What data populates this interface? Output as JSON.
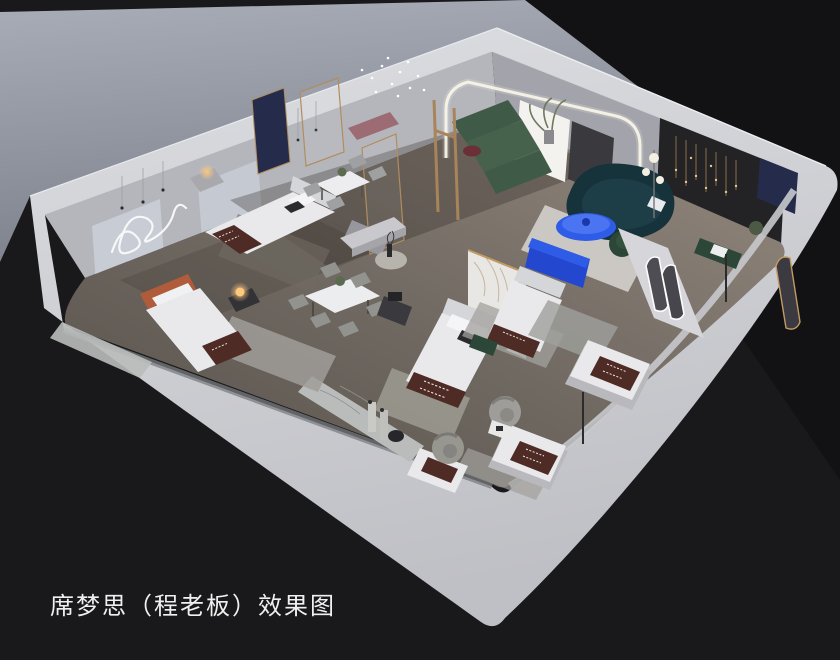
{
  "caption": "席梦思（程老板）效果图",
  "scene_type": "isometric-cutaway-interior-rendering",
  "colors": {
    "bg": "#19191b",
    "bg_deep": "#121214",
    "backdrop_hi": "#a9adb8",
    "backdrop_lo": "#7e828c",
    "shell": "#cfd0d4",
    "shell_hi": "#dddee2",
    "shell_lo": "#bfc0c5",
    "wall_left": "#b5b6bc",
    "wall_left_lo": "#9698a0",
    "wall_right": "#a3a4ab",
    "panel": "#c8ccd5",
    "charcoal": "#232326",
    "navy": "#252b4a",
    "floor_hi": "#94897e",
    "floor_lo": "#6f6861",
    "floor_dark": "#57514b",
    "marble": "#b9bcba",
    "wood": "#a8845a",
    "gold": "#c39a64",
    "bedding": "#e9e9ec",
    "bedding_lo": "#d5d6da",
    "runner": "#4e2b24",
    "rug": "#a09e99",
    "rug_light": "#d8d6d2",
    "green": "#3f5a47",
    "green_deep": "#2c4737",
    "teal": "#16323b",
    "blue": "#2e5ce6",
    "blue_lo": "#2348cf",
    "rust": "#b05c3a",
    "mauve": "#9c6b74",
    "glow": "#ffc97d",
    "line": "#f4f1ea",
    "caption": "#f0f0f0"
  }
}
